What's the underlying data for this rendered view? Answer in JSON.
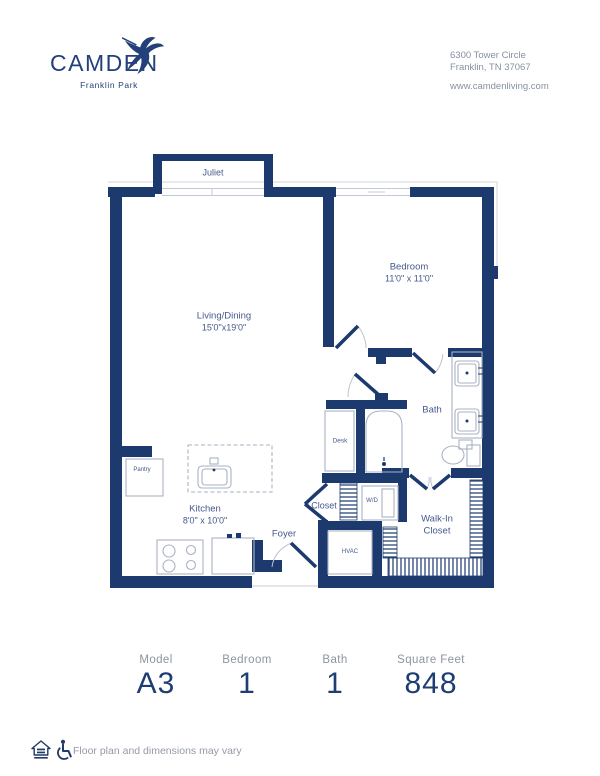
{
  "header": {
    "logo_name": "CAMDEN",
    "logo_subname": "Franklin Park",
    "address_line1": "6300 Tower Circle",
    "address_line2": "Franklin, TN 37067",
    "website": "www.camdenliving.com"
  },
  "floorplan": {
    "balcony": "Juliet",
    "living_label": "Living/Dining",
    "living_dims": "15'0\"x19'0\"",
    "bedroom_label": "Bedroom",
    "bedroom_dims": "11'0\" x 11'0\"",
    "bath_label": "Bath",
    "kitchen_label": "Kitchen",
    "kitchen_dims": "8'0\" x 10'0\"",
    "pantry_label": "Pantry",
    "desk_label": "Desk",
    "closet_label": "Closet",
    "washer_dryer_label": "W/D",
    "hvac_label": "HVAC",
    "walkin_closet_label": "Walk-In Closet",
    "foyer_label": "Foyer"
  },
  "summary": {
    "columns": [
      {
        "label": "Model",
        "value": "A3"
      },
      {
        "label": "Bedroom",
        "value": "1"
      },
      {
        "label": "Bath",
        "value": "1"
      },
      {
        "label": "Square Feet",
        "value": "848"
      }
    ]
  },
  "footer": {
    "disclaimer": "Floor plan and dimensions may vary"
  },
  "colors": {
    "wall_navy": "#1c3a6e",
    "label_blue": "#46598c",
    "muted_gray": "#8d94a0",
    "fixture_gray": "#a9b2c2"
  }
}
